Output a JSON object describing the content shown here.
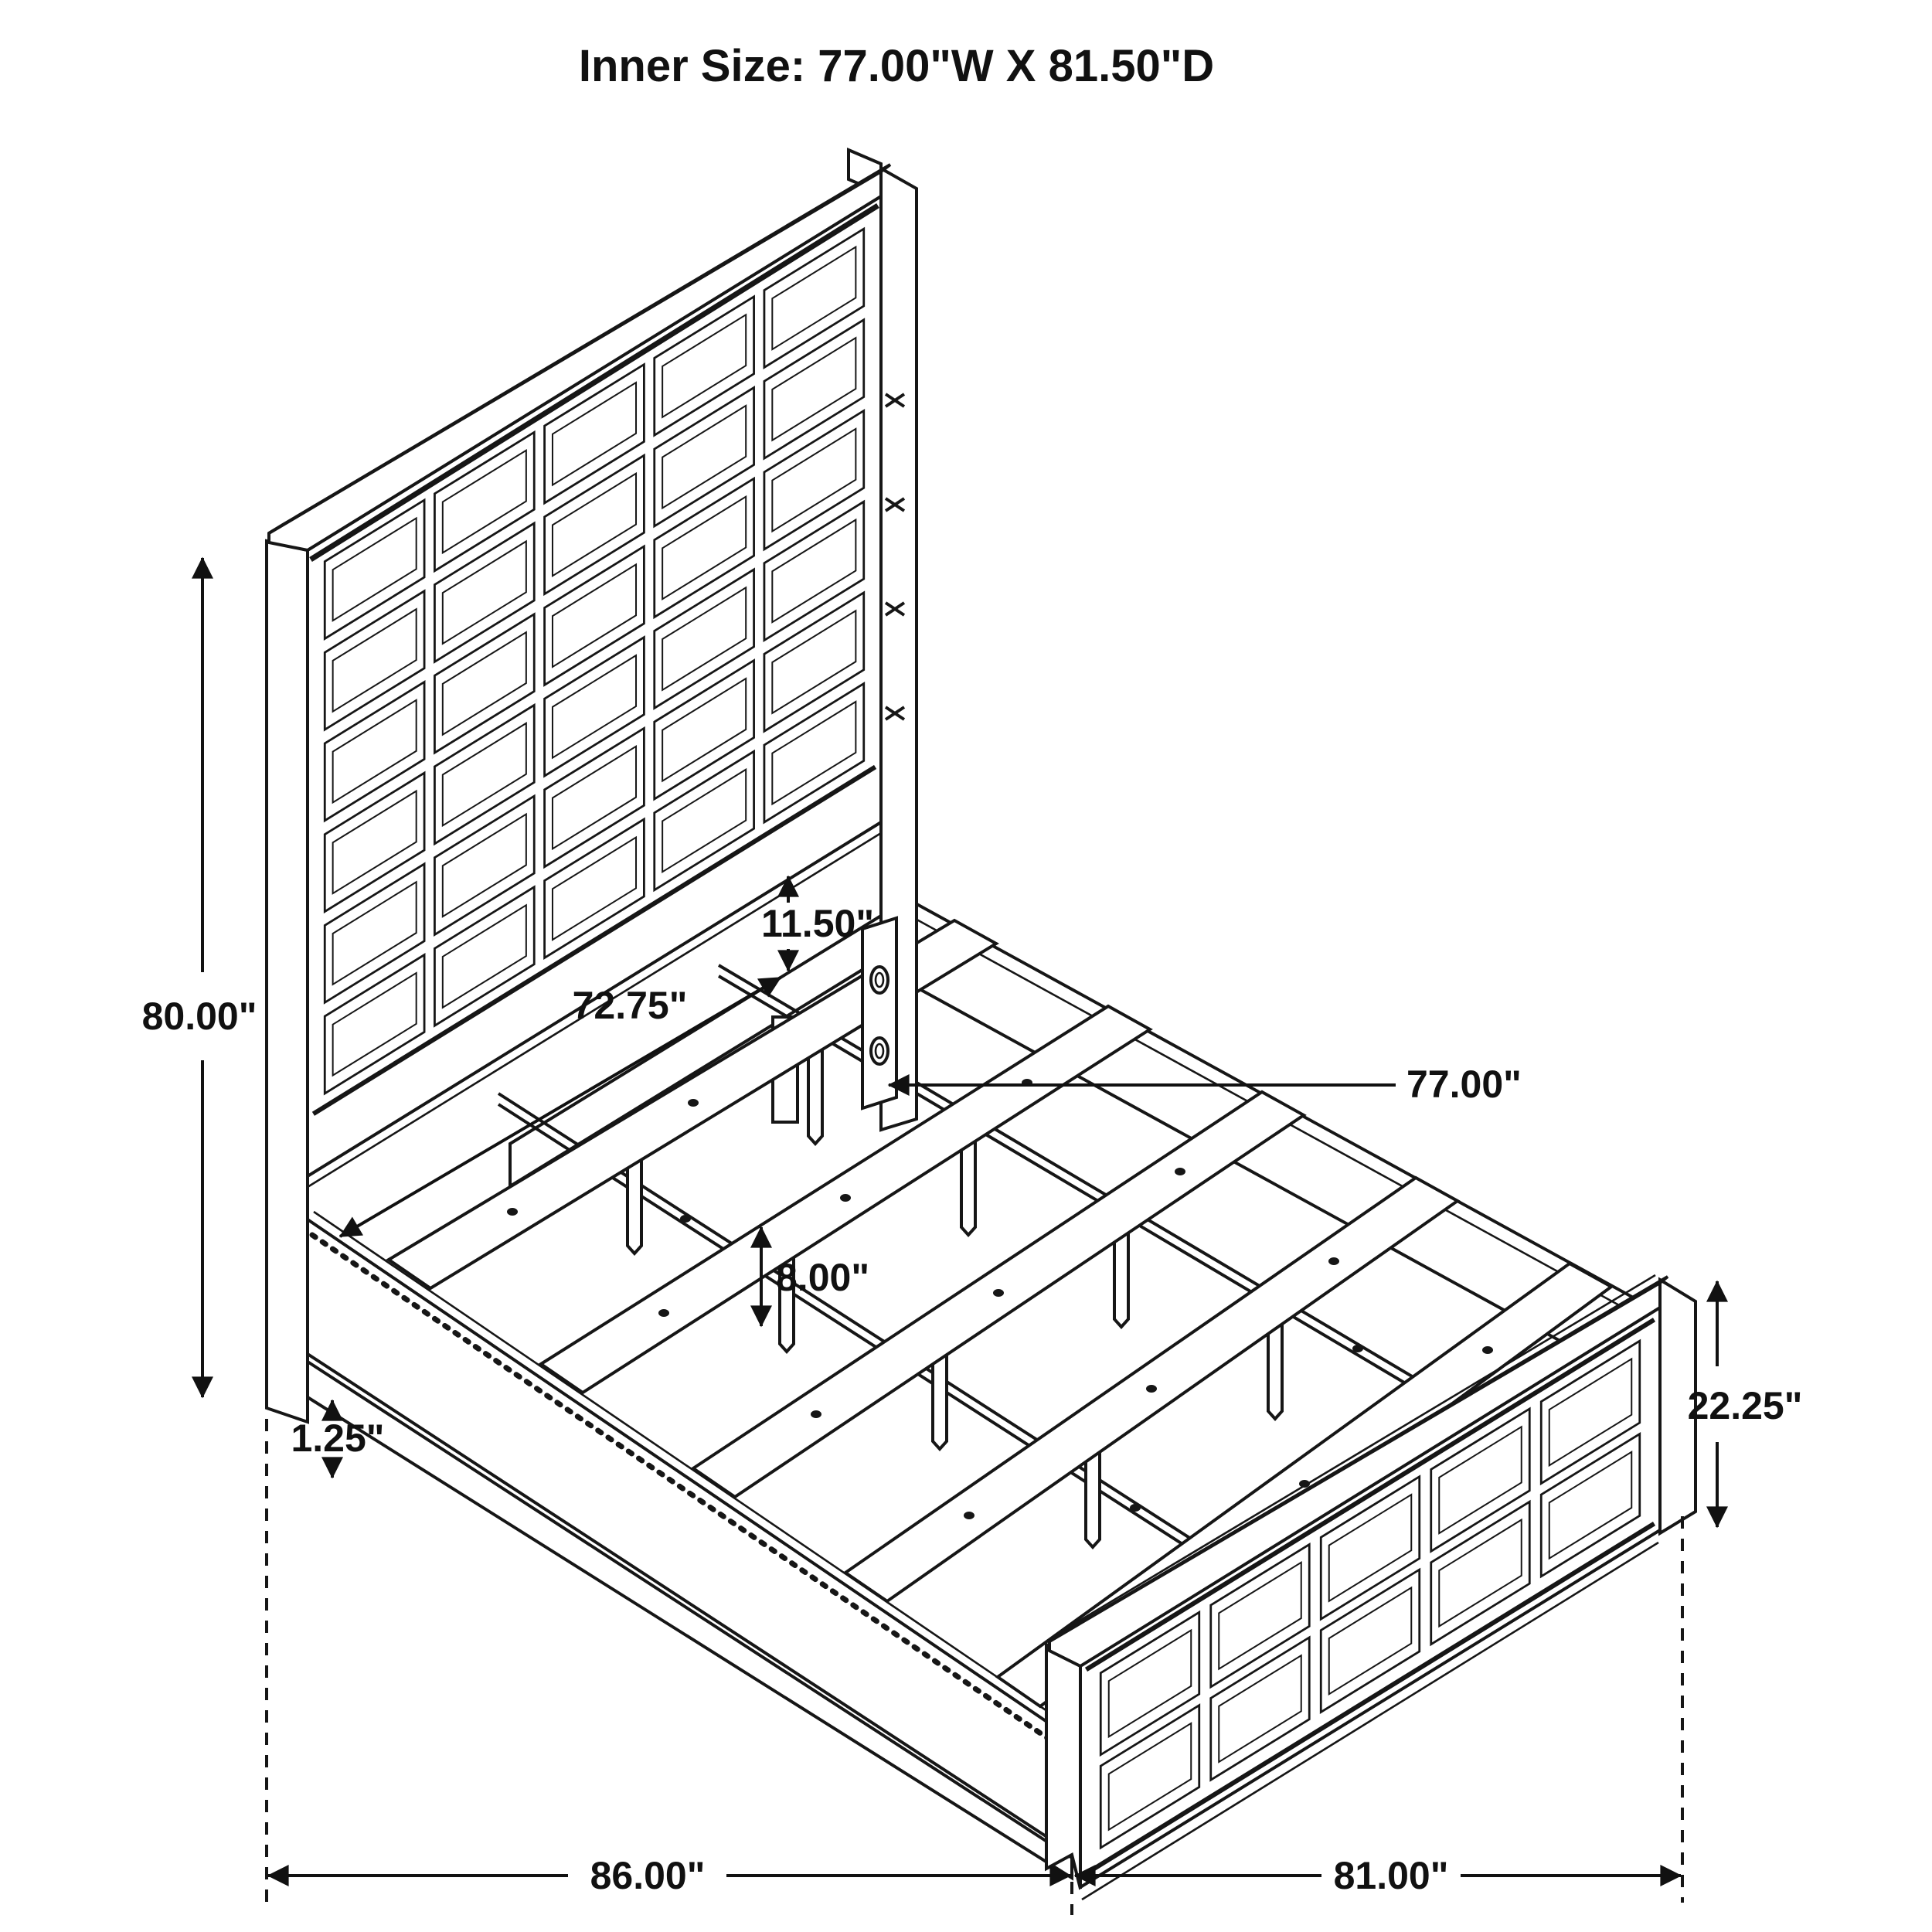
{
  "title": "Inner Size: 77.00\"W X 81.50\"D",
  "dimensions": {
    "headboard_height": "80.00\"",
    "headboard_inner_width": "72.75\"",
    "headboard_rail_gap": "11.50\"",
    "slat_length": "77.00\"",
    "slat_leg_height": "8.00\"",
    "side_rail_lip": "1.25\"",
    "footboard_height": "22.25\"",
    "overall_length": "86.00\"",
    "overall_width": "81.00\""
  },
  "colors": {
    "line": "#161616",
    "background": "#ffffff"
  }
}
